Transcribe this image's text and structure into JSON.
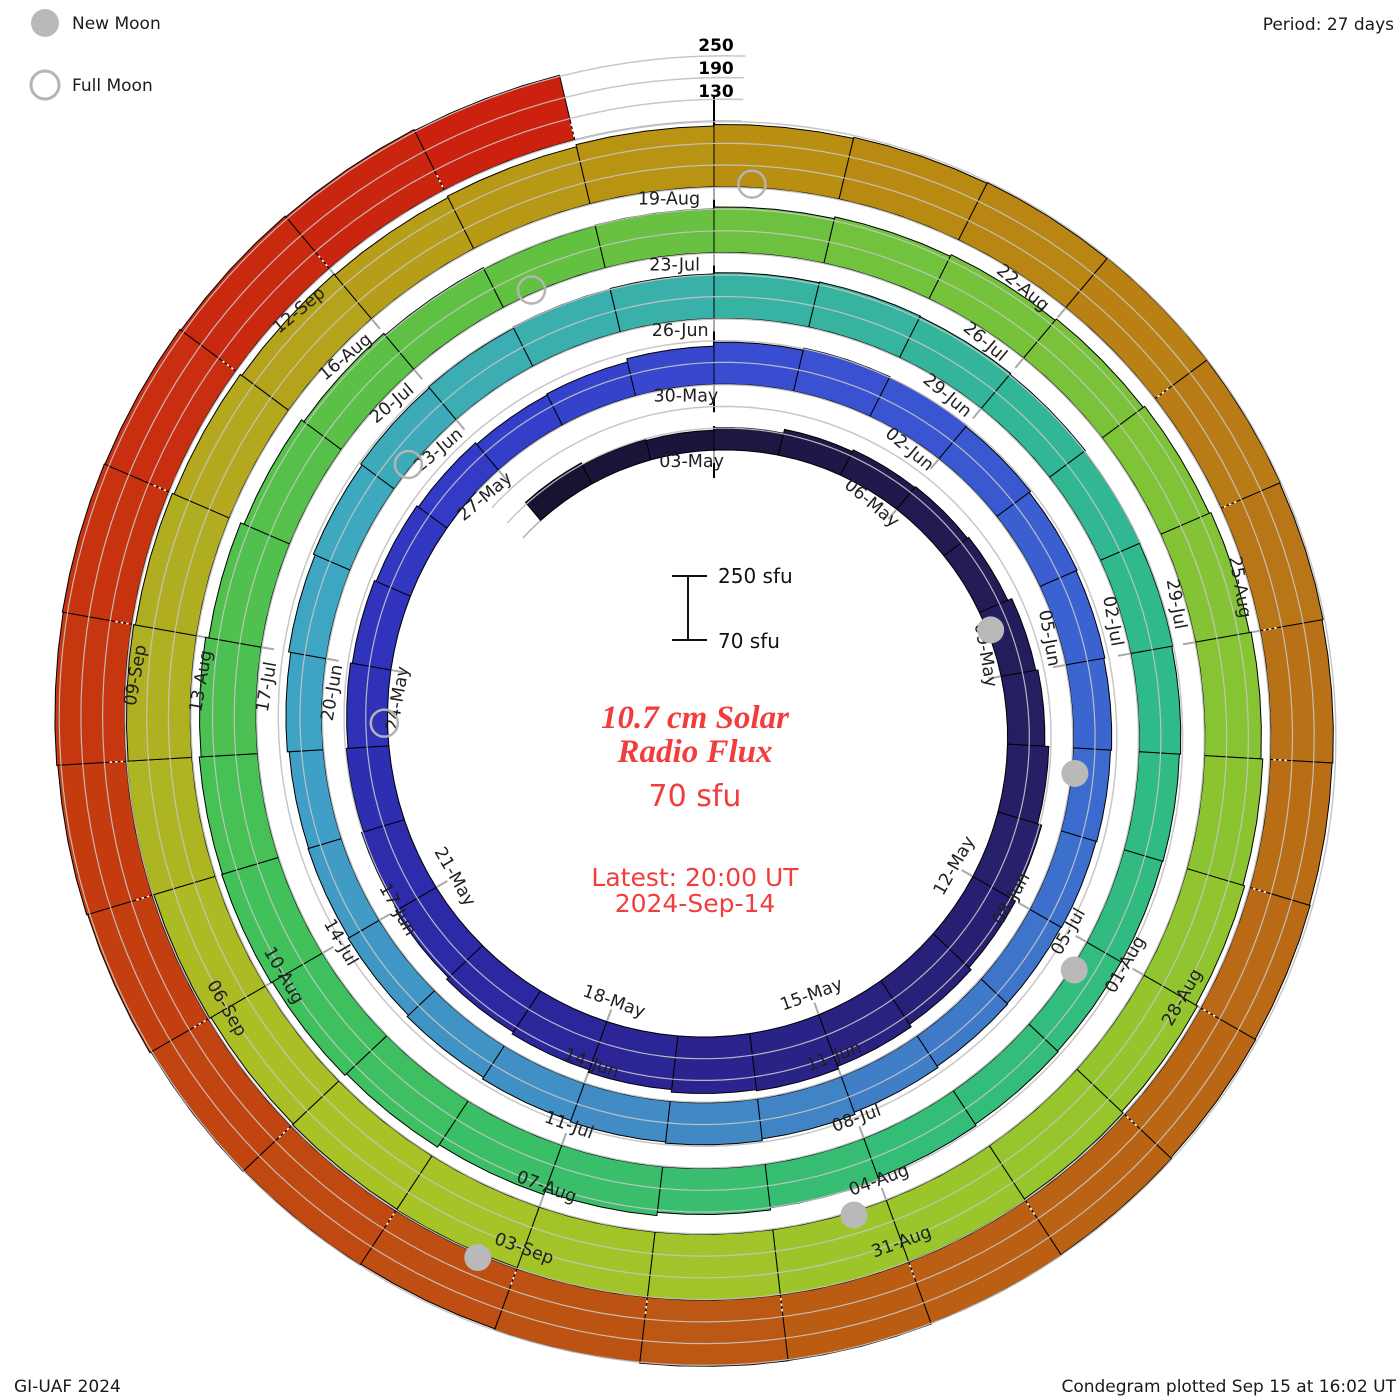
{
  "header": {
    "period": "Period: 27 days"
  },
  "legend": {
    "new_moon": "New Moon",
    "full_moon": "Full Moon"
  },
  "footer": {
    "credit": "GI-UAF 2024",
    "plotted": "Condegram plotted Sep 15 at 16:02 UT"
  },
  "center": {
    "title_line1": "10.7 cm Solar",
    "title_line2": "Radio Flux",
    "baseline_value": "70 sfu",
    "latest_line1": "Latest: 20:00 UT",
    "latest_line2": "2024-Sep-14",
    "text_color": "#f23d3d"
  },
  "scale_bar": {
    "top_label": "250 sfu",
    "bottom_label": "70 sfu"
  },
  "radial_scale_labels": [
    "250",
    "190",
    "130"
  ],
  "chart_data": {
    "type": "bar",
    "subtype": "spiral-condegram",
    "title": "10.7 cm Solar Radio Flux",
    "units": "sfu",
    "period_days": 27,
    "flux_baseline": 70,
    "flux_gridlines": [
      130,
      190,
      250
    ],
    "start_date": "2024-Apr-30",
    "end_date": "2024-Sep-14",
    "day_offset_of_first_bar_from_03May": -3,
    "flux_daily": [
      135,
      128,
      125,
      132,
      143,
      148,
      151,
      155,
      167,
      173,
      184,
      196,
      206,
      214,
      222,
      229,
      226,
      219,
      212,
      206,
      199,
      193,
      188,
      183,
      178,
      173,
      168,
      163,
      166,
      175,
      186,
      192,
      190,
      186,
      182,
      179,
      176,
      173,
      171,
      169,
      171,
      175,
      181,
      186,
      183,
      179,
      174,
      169,
      166,
      164,
      169,
      175,
      180,
      185,
      188,
      191,
      193,
      196,
      198,
      196,
      193,
      190,
      188,
      185,
      182,
      180,
      179,
      181,
      185,
      191,
      197,
      206,
      215,
      223,
      229,
      233,
      231,
      226,
      217,
      207,
      199,
      193,
      189,
      191,
      196,
      201,
      206,
      211,
      216,
      221,
      226,
      231,
      236,
      241,
      246,
      250,
      252,
      253,
      251,
      248,
      246,
      243,
      247,
      250,
      246,
      241,
      236,
      231,
      228,
      232,
      238,
      242,
      245,
      247,
      249,
      248,
      246,
      243,
      241,
      243,
      245,
      248,
      250,
      252,
      253,
      250,
      246,
      249,
      252,
      256,
      259,
      262,
      264,
      262,
      259,
      256,
      253
    ],
    "tick_label_step_days": 3,
    "tick_labels": [
      "03-May",
      "06-May",
      "09-May",
      "12-May",
      "15-May",
      "18-May",
      "21-May",
      "24-May",
      "27-May",
      "30-May",
      "02-Jun",
      "05-Jun",
      "08-Jun",
      "11-Jun",
      "14-Jun",
      "17-Jun",
      "20-Jun",
      "23-Jun",
      "26-Jun",
      "29-Jun",
      "02-Jul",
      "05-Jul",
      "08-Jul",
      "11-Jul",
      "14-Jul",
      "17-Jul",
      "20-Jul",
      "23-Jul",
      "26-Jul",
      "29-Jul",
      "01-Aug",
      "04-Aug",
      "07-Aug",
      "10-Aug",
      "13-Aug",
      "16-Aug",
      "19-Aug",
      "22-Aug",
      "25-Aug",
      "28-Aug",
      "31-Aug",
      "03-Sep",
      "06-Sep",
      "09-Sep",
      "12-Sep"
    ],
    "new_moons": {
      "dates": [
        "08-May",
        "06-Jun",
        "05-Jul",
        "04-Aug",
        "03-Sep"
      ],
      "day_offsets": [
        5,
        34,
        63,
        93,
        123
      ]
    },
    "full_moons": {
      "dates": [
        "23-May",
        "22-Jun",
        "21-Jul",
        "19-Aug"
      ],
      "day_offsets": [
        20,
        50,
        79,
        108
      ]
    },
    "colormap_stops": [
      [
        -3,
        "#171231"
      ],
      [
        3,
        "#211a4e"
      ],
      [
        9,
        "#27206e"
      ],
      [
        14,
        "#2b2492"
      ],
      [
        19,
        "#2e2cb0"
      ],
      [
        24,
        "#323cc8"
      ],
      [
        28,
        "#3a4fd2"
      ],
      [
        34,
        "#3b68d0"
      ],
      [
        40,
        "#4186c4"
      ],
      [
        48,
        "#3fa5c6"
      ],
      [
        54,
        "#38b2a6"
      ],
      [
        60,
        "#2eba8b"
      ],
      [
        66,
        "#35bd74"
      ],
      [
        72,
        "#40c05c"
      ],
      [
        78,
        "#5cc144"
      ],
      [
        84,
        "#78c23a"
      ],
      [
        90,
        "#92c52e"
      ],
      [
        97,
        "#a8c426"
      ],
      [
        103,
        "#b2ab20"
      ],
      [
        108,
        "#b99110"
      ],
      [
        114,
        "#b97317"
      ],
      [
        121,
        "#bb5a13"
      ],
      [
        127,
        "#c43d10"
      ],
      [
        134,
        "#cc1f0e"
      ]
    ],
    "gridline_color": "#c6c6c6",
    "baseline_color": "#adadad",
    "moon_marker_color": "#b9b9b9",
    "legend_position": "top-left"
  }
}
